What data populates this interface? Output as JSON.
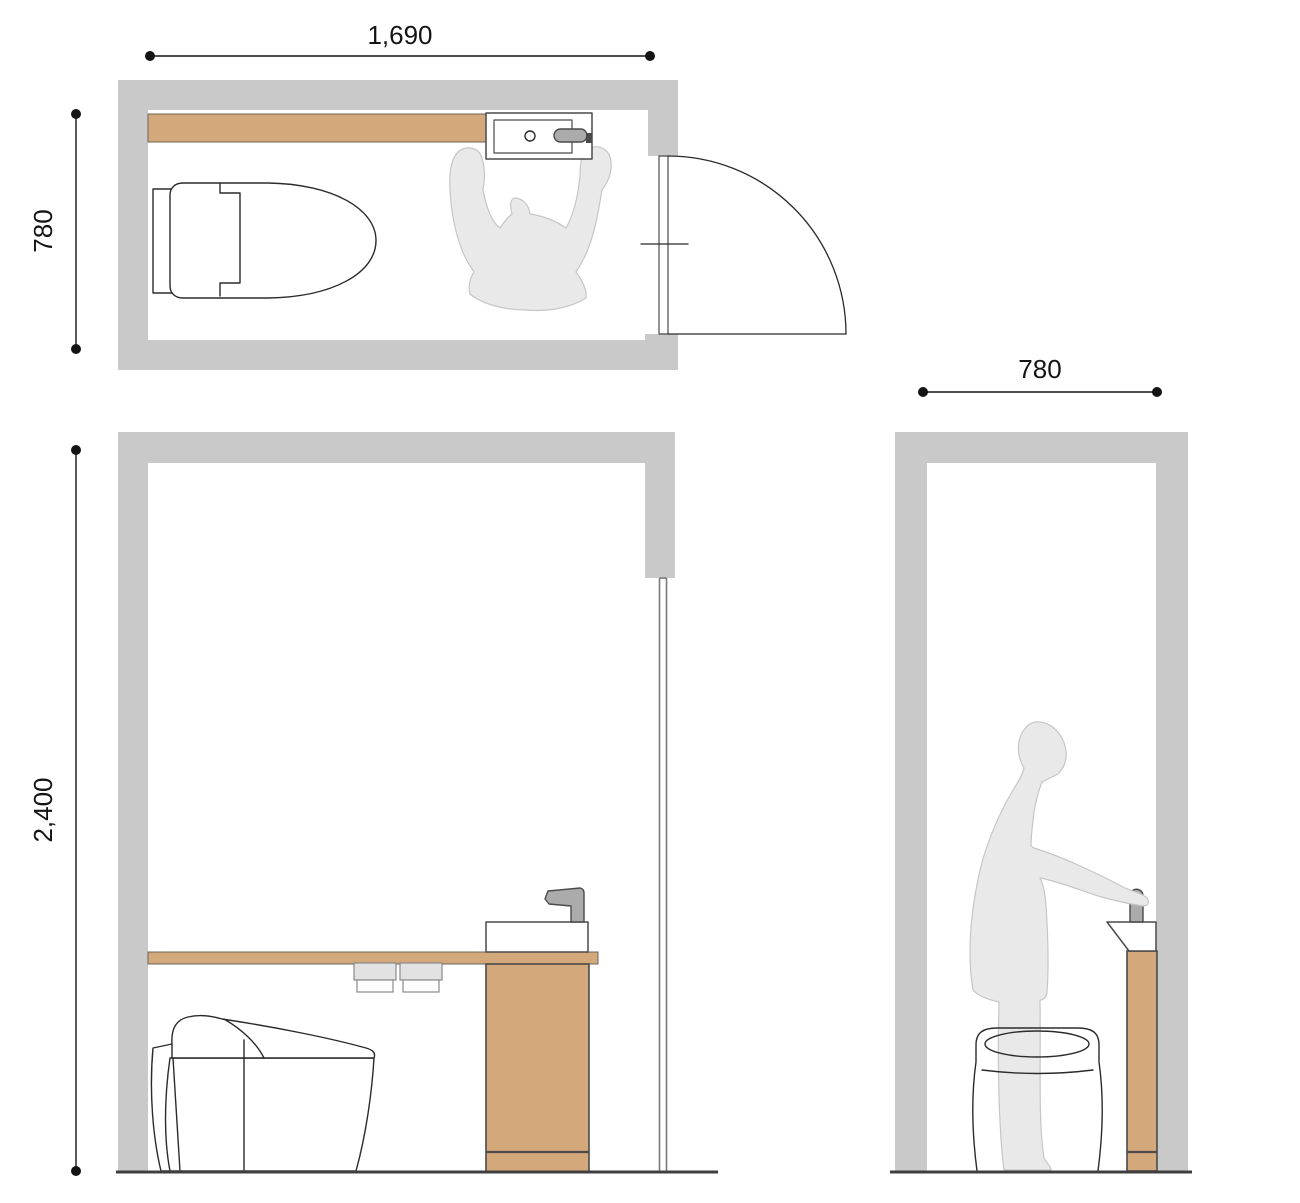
{
  "drawing": {
    "type": "toilet-room plan and elevations",
    "views": {
      "plan": "top-down floor plan with toilet, counter, hand-wash sink, user and door swing",
      "front_elevation": "interior elevation with toilet side view, counter, sink cabinet and paper holders",
      "side_elevation": "cross-section elevation with standing figure at hand-wash pedestal and toilet front view"
    }
  },
  "dimensions": {
    "plan_width": "1,690",
    "plan_depth": "780",
    "ceiling_height": "2,400",
    "room_width": "780"
  },
  "colors": {
    "wall": "#c9c9c9",
    "counter_wood": "#d3a97c",
    "silhouette": "#e9e9e9",
    "faucet_metal": "#ababab",
    "line_ink": "#2b2b2b",
    "floor_line": "#3f3f3f",
    "dimension_ink": "#141414"
  }
}
